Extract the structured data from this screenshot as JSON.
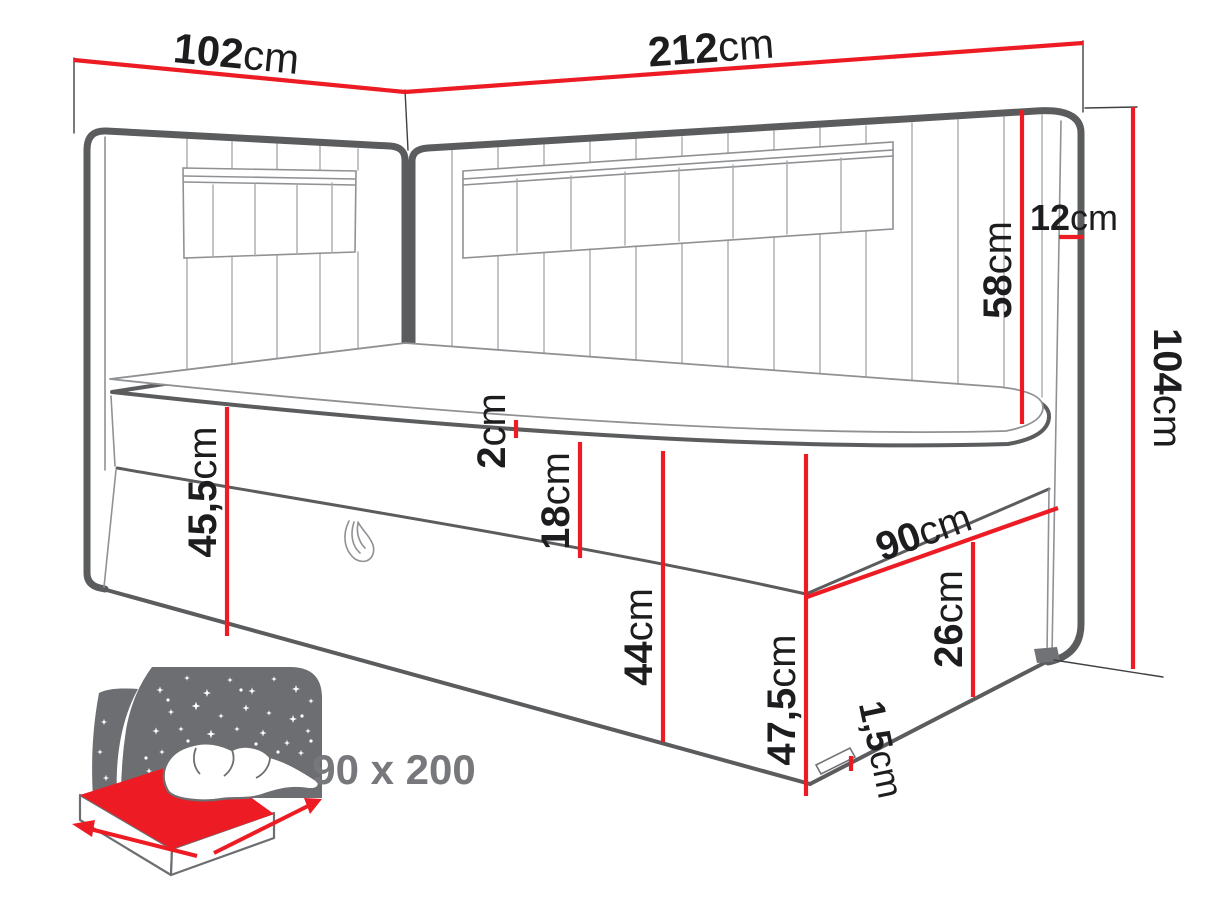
{
  "diagram": {
    "type": "furniture dimension drawing",
    "subject": "corner continental bed with upholstered headboards and storage box",
    "unit": "cm"
  },
  "colors": {
    "dimension_red": "#ed1c24",
    "drawing_gray": "#5b5c5e",
    "text_dark": "#1d1d1f",
    "muted_gray": "#77787b"
  },
  "dims": {
    "side_width": {
      "value": "102",
      "unit": "cm"
    },
    "back_width": {
      "value": "212",
      "unit": "cm"
    },
    "headboard_thickness": {
      "value": "12",
      "unit": "cm"
    },
    "headboard_above": {
      "value": "58",
      "unit": "cm"
    },
    "total_height": {
      "value": "104",
      "unit": "cm"
    },
    "topper_height": {
      "value": "2",
      "unit": "cm"
    },
    "mattress_height": {
      "value": "18",
      "unit": "cm"
    },
    "side_height": {
      "value": "45,5",
      "unit": "cm"
    },
    "front_height": {
      "value": "44",
      "unit": "cm"
    },
    "corner_height": {
      "value": "47,5",
      "unit": "cm"
    },
    "foot_width": {
      "value": "90",
      "unit": "cm"
    },
    "box_height": {
      "value": "26",
      "unit": "cm"
    },
    "floor_gap": {
      "value": "1,5",
      "unit": "cm"
    }
  },
  "badge": {
    "size": "90 x 200"
  }
}
